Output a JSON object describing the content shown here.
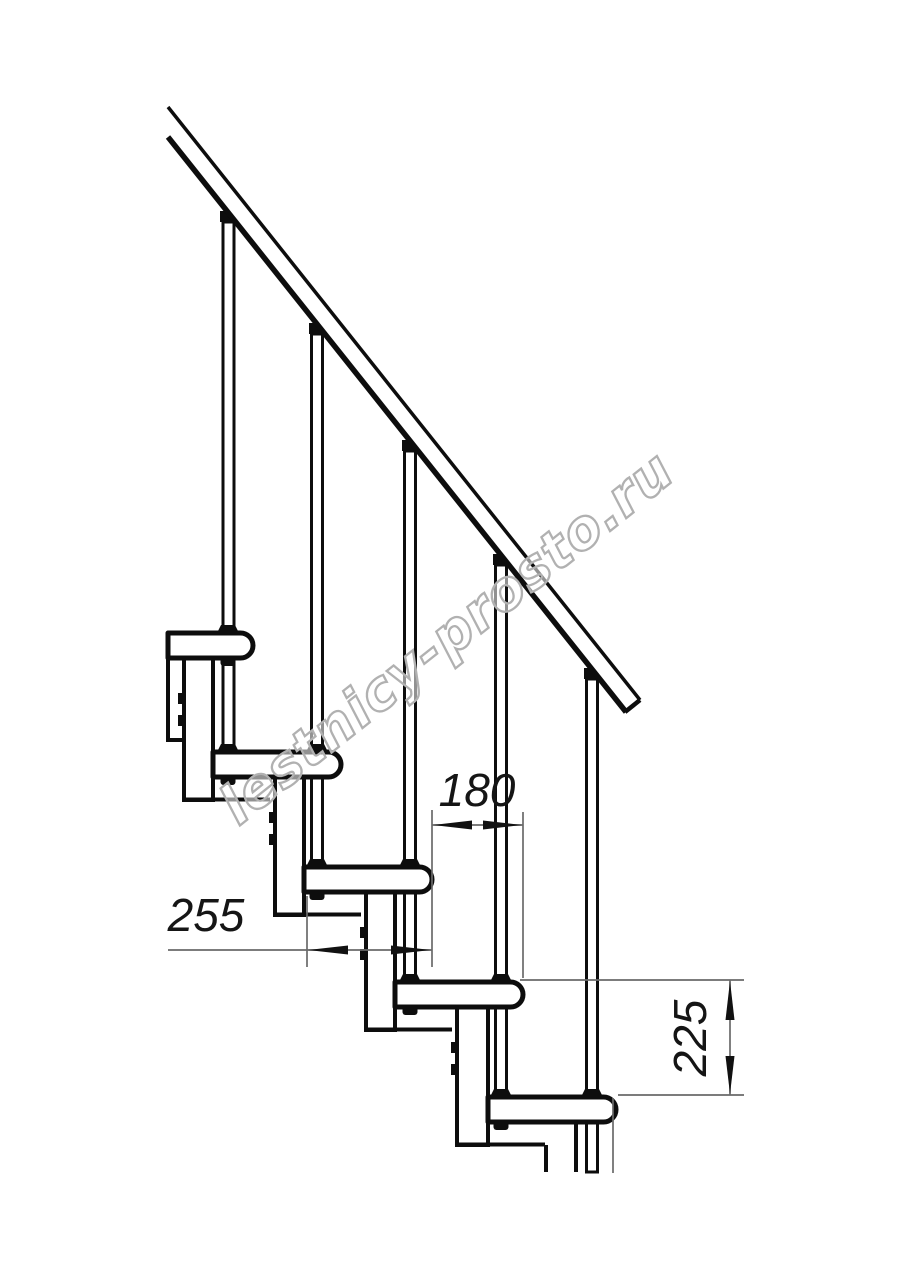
{
  "drawing": {
    "title": "modular-staircase-side-elevation",
    "watermark": "lestnicy-prosto.ru",
    "dimensions": {
      "step_run": "180",
      "tread_depth": "255",
      "riser_height": "225"
    },
    "colors": {
      "line": "#0d0d0d",
      "dimension_line": "#6a6a6a",
      "watermark_outline": "#b1b1b1",
      "background": "#ffffff"
    }
  }
}
